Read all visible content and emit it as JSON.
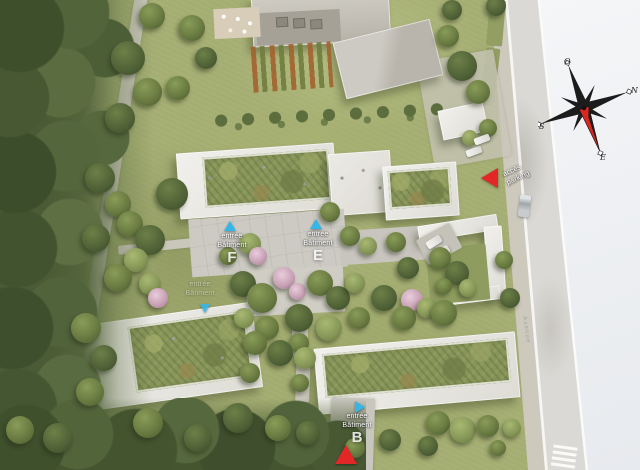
{
  "plan": {
    "entrances": {
      "f": {
        "line1": "entrée",
        "line2": "Bâtiment",
        "letter": "F"
      },
      "e": {
        "line1": "entrée",
        "line2": "Bâtiment",
        "letter": "E"
      },
      "b": {
        "line1": "entrée",
        "line2": "Bâtiment",
        "letter": "B"
      },
      "secondary": {
        "line1": "entrée",
        "line2": "Bâtiment"
      }
    },
    "parking_access": {
      "line1": "accès",
      "line2": "parking"
    },
    "street_name": "Avenue",
    "compass": {
      "north": "N",
      "east": "E",
      "south": "S",
      "west": "O"
    },
    "colors": {
      "entrance_marker": "#35b6e8",
      "parking_marker": "#e32726",
      "green_roof": "#87945a",
      "building_white": "#ecebe6",
      "road": "#dad9d5",
      "margin_white": "#f0f2f4"
    }
  }
}
